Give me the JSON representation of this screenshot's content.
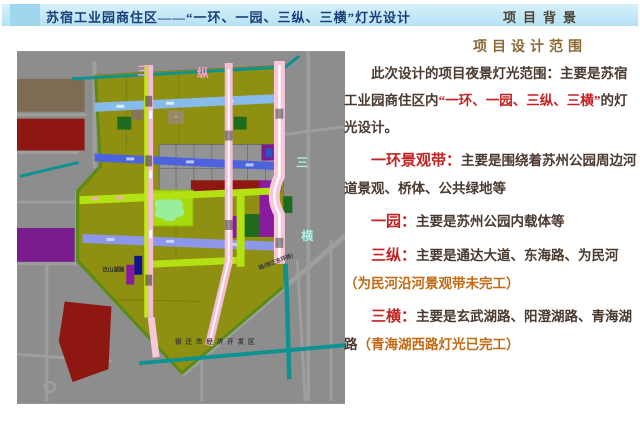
{
  "header": {
    "title": "苏宿工业园商住区——“一环、一园、三纵、三横”灯光设计",
    "corner_label": "项目背景"
  },
  "content": {
    "section_title": "项目设计范围",
    "intro": [
      {
        "text": "此次设计的项目夜景灯光范围：主要是苏宿工业园商住区内"
      },
      {
        "text": "“一环、一园、三纵、三横”"
      },
      {
        "text": "的灯光设计。"
      }
    ],
    "items": [
      {
        "term": "一环景观带：",
        "desc": "主要是围绕着苏州公园周边河道景观、桥体、公共绿地等",
        "note": ""
      },
      {
        "term": "一园：",
        "desc": "主要是苏州公园内载体等",
        "note": ""
      },
      {
        "term": "三纵：",
        "desc": "主要是通达大道、东海路、为民河",
        "note": "（为民河沿河景观带未完工）"
      },
      {
        "term": "三横：",
        "desc": "主要是玄武湖路、阳澄湖路、青海湖路",
        "note": "（青海湖西路灯光已完工）"
      }
    ]
  },
  "map": {
    "labels": {
      "san_zong": [
        "三",
        "纵"
      ],
      "san_heng": [
        "三",
        "横"
      ],
      "dev_zone": "宿迁市经济开发区",
      "road_small_1": "泛山湖路",
      "road_small_2": "路(宿迁东环路)"
    },
    "legend_colors": {
      "residential_olive": "#8f8f12",
      "park_green": "#a6da0c",
      "existing_blocks_gray": "#949494",
      "red_zone": "#8e1711",
      "purple_zone": "#8a1b9e",
      "river_teal": "#0d9292",
      "road_blue": "#4d63de",
      "road_light_blue": "#87bbea",
      "road_lavender": "#8d97e9",
      "road_pink": "#f5bdd3",
      "road_lime": "#b4e112"
    }
  },
  "colors": {
    "header_bar": "#c5e9f7",
    "header_accent": "#9ed7ee",
    "title_text": "#1b3e78",
    "corner_label": "#4b4434",
    "section_title": "#8a6a35",
    "body_text": "#4a3a30",
    "highlight_red": "#c32222",
    "note_orange": "#c26a14"
  }
}
